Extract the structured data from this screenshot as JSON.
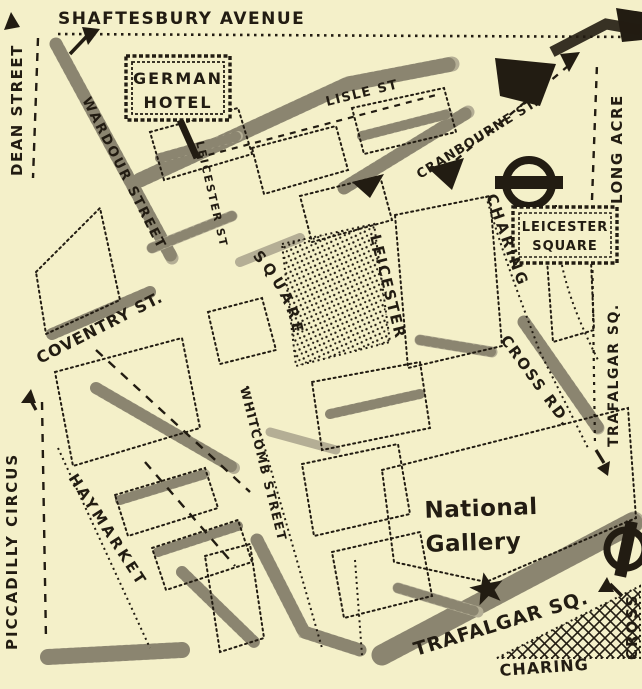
{
  "map": {
    "colors": {
      "paper": "#f4f0c9",
      "ink": "#221c12",
      "band": "#b4ae95"
    },
    "labels": {
      "shaftesbury_avenue": "SHAFTESBURY AVENUE",
      "dean_street": "DEAN STREET",
      "wardour_street": "WARDOUR STREET",
      "lisle_st": "LISLE ST",
      "cranbourne_st": "CRANBOURNE ST.",
      "long_acre": "LONG ACRE",
      "leicester_st": "LEICESTER ST",
      "coventry_st": "COVENTRY ST.",
      "leicester": "LEICESTER",
      "square": "SQUARE",
      "charing": "CHARING",
      "cross_rd": "CROSS RD.",
      "trafalgar_sq_side": "TRAFALGAR SQ.",
      "piccadilly_circus": "PICCADILLY CIRCUS",
      "haymarket": "HAYMARKET",
      "whitcomb_street": "WHITCOMB STREET",
      "trafalgar_sq_road": "TRAFALGAR SQ.",
      "charing_cross_bottom_h": "CHARING",
      "charing_cross_bottom_v": "CROSS"
    },
    "hotel_sign": {
      "line1": "GERMAN",
      "line2": "HOTEL"
    },
    "station_sign": {
      "line1": "LEICESTER",
      "line2": "SQUARE"
    },
    "national_gallery": {
      "line1": "National",
      "line2": "Gallery"
    },
    "icons": {
      "leicester_square_station": "underground-roundel",
      "charing_cross_station": "underground-roundel",
      "national_gallery_marker": "star"
    }
  }
}
